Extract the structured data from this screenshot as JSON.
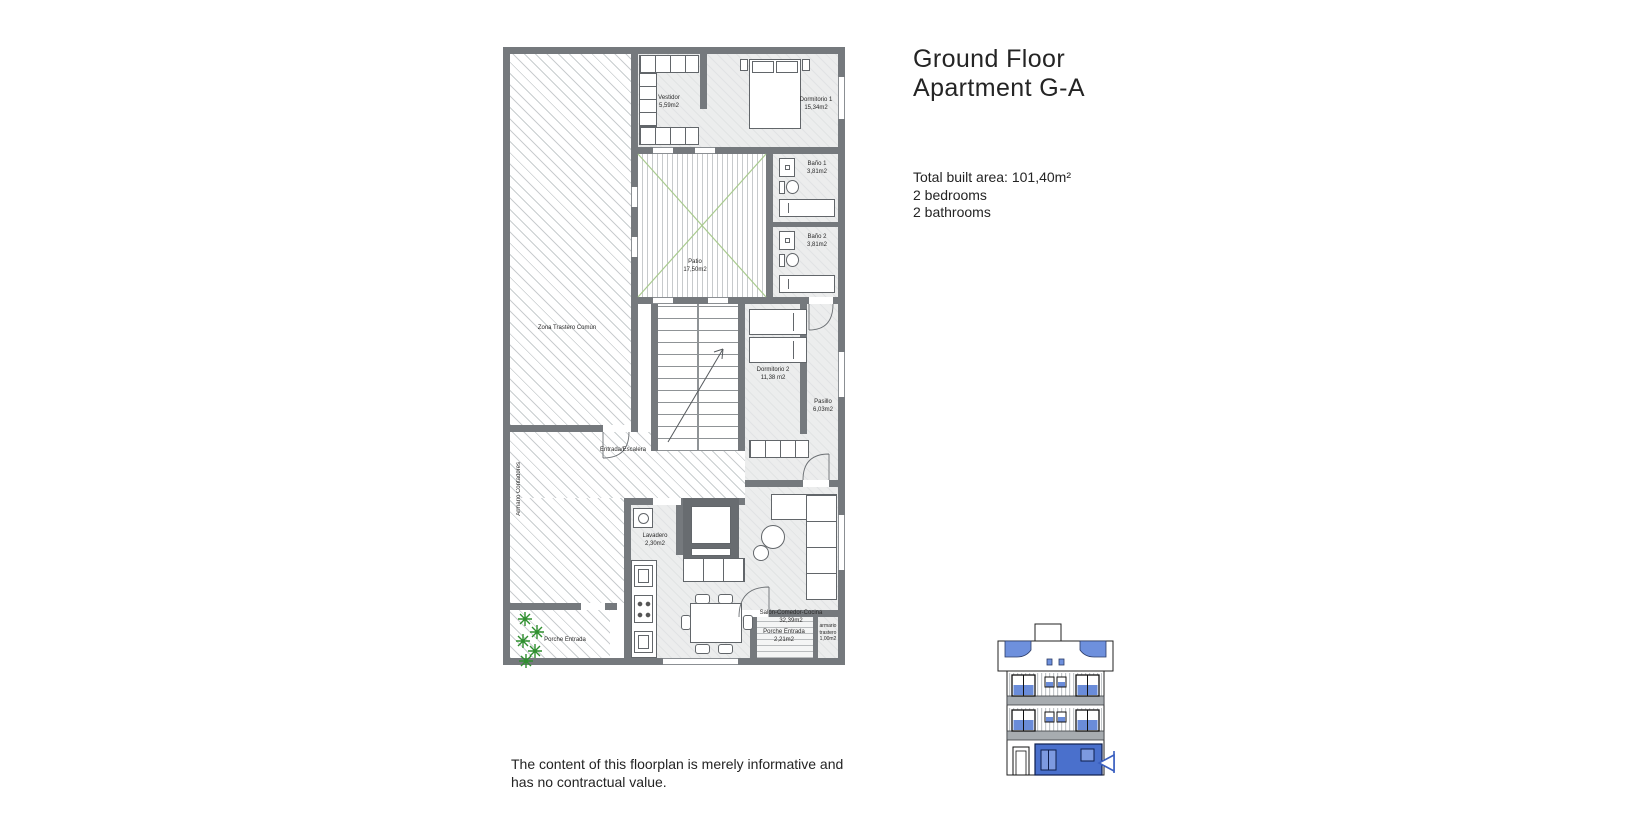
{
  "header": {
    "title": [
      "Ground Floor",
      "Apartment G-A"
    ],
    "specs": [
      "Total built area: 101,40m²",
      "2 bedrooms",
      "2 bathrooms"
    ]
  },
  "disclaimer": [
    "The content of this floorplan is merely informative and",
    "has no contractual value."
  ],
  "floorplan": {
    "rooms": [
      {
        "id": "vestidor",
        "name": "Vestidor",
        "area": "5,59m2"
      },
      {
        "id": "dormitorio-1",
        "name": "Dormitorio 1",
        "area": "15,34m2"
      },
      {
        "id": "bano-1",
        "name": "Baño 1",
        "area": "3,81m2"
      },
      {
        "id": "bano-2",
        "name": "Baño 2",
        "area": "3,81m2"
      },
      {
        "id": "patio",
        "name": "Patio",
        "area": "17,50m2"
      },
      {
        "id": "zona-trastero-comun",
        "name": "Zona Trastero Común",
        "area": ""
      },
      {
        "id": "dormitorio-2",
        "name": "Dormitorio 2",
        "area": "11,38 m2"
      },
      {
        "id": "pasillo",
        "name": "Pasillo",
        "area": "6,03m2"
      },
      {
        "id": "entrada-escalera",
        "name": "Entrada/Escalera",
        "area": ""
      },
      {
        "id": "armario-contadores",
        "name": "Armario Contadores",
        "area": ""
      },
      {
        "id": "lavadero",
        "name": "Lavadero",
        "area": "2,30m2"
      },
      {
        "id": "salon-comedor-cocina",
        "name": "Salón-Comedor-Cocina",
        "area": "32,39m2"
      },
      {
        "id": "porche-entrada-izq",
        "name": "Porche Entrada",
        "area": ""
      },
      {
        "id": "porche-entrada-der",
        "name": "Porche Entrada",
        "area": "2,21m2"
      },
      {
        "id": "armario-trastero",
        "name": "armario trastero",
        "area": "1,00m2"
      }
    ]
  },
  "elevation": {
    "description": "building front elevation with ground floor apartment highlighted",
    "highlight": "ground-floor-apartment"
  },
  "colors": {
    "wall": "#75797d",
    "floor": "#eceded",
    "hatch": "#c9cdcf",
    "patio_green": "#a8ca8e",
    "plant_green": "#2f8f2f",
    "elevation_blue": "#4a70cc",
    "glass_blue": "#7d9ae0",
    "awning_blue": "#6e90dd",
    "text": "#242424"
  }
}
